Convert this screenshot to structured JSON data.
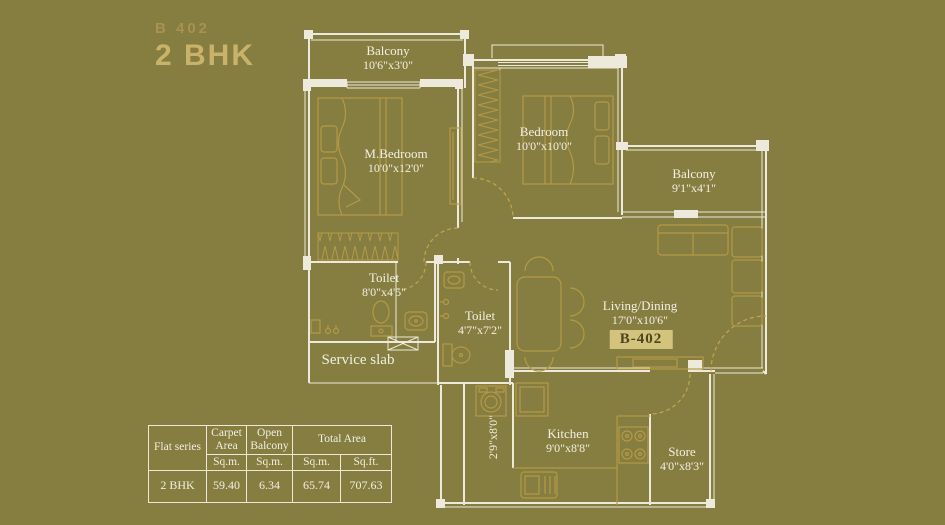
{
  "title": {
    "series": "B 402",
    "type": "2 BHK"
  },
  "plan": {
    "unit_badge": "B-402",
    "service_slab_label": "Service slab",
    "rooms": [
      {
        "id": "balcony-top",
        "name": "Balcony",
        "dims": "10'6\"x3'0\""
      },
      {
        "id": "m-bedroom",
        "name": "M.Bedroom",
        "dims": "10'0\"x12'0\""
      },
      {
        "id": "bedroom",
        "name": "Bedroom",
        "dims": "10'0\"x10'0\""
      },
      {
        "id": "balcony-right",
        "name": "Balcony",
        "dims": "9'1\"x4'1\""
      },
      {
        "id": "toilet-attached",
        "name": "Toilet",
        "dims": "8'0\"x4'5\""
      },
      {
        "id": "toilet-common",
        "name": "Toilet",
        "dims": "4'7\"x7'2\""
      },
      {
        "id": "living-dining",
        "name": "Living/Dining",
        "dims": "17'0\"x10'6\""
      },
      {
        "id": "kitchen",
        "name": "Kitchen",
        "dims": "9'0\"x8'8\""
      },
      {
        "id": "store",
        "name": "Store",
        "dims": "4'0\"x8'3\""
      },
      {
        "id": "utility",
        "name": "",
        "dims": "2'9\"x8'0\""
      }
    ]
  },
  "colors": {
    "background": "#867d41",
    "wall_line": "#eeeadb",
    "furniture_line": "#b49a45",
    "title_accent": "#c9b269",
    "badge_bg": "#d3c37d",
    "badge_text": "#4c451e",
    "label_text": "#f3f0e2"
  },
  "area_table": {
    "headers": {
      "flat_series": "Flat series",
      "carpet_area": "Carpet Area",
      "open_balcony": "Open Balcony",
      "total_area": "Total Area",
      "unit_sqm_1": "Sq.m.",
      "unit_sqm_2": "Sq.m.",
      "unit_sqm_3": "Sq.m.",
      "unit_sqft": "Sq.ft."
    },
    "rows": [
      {
        "flat": "2 BHK",
        "carpet_sqm": "59.40",
        "open_balcony_sqm": "6.34",
        "total_sqm": "65.74",
        "total_sqft": "707.63"
      }
    ]
  }
}
